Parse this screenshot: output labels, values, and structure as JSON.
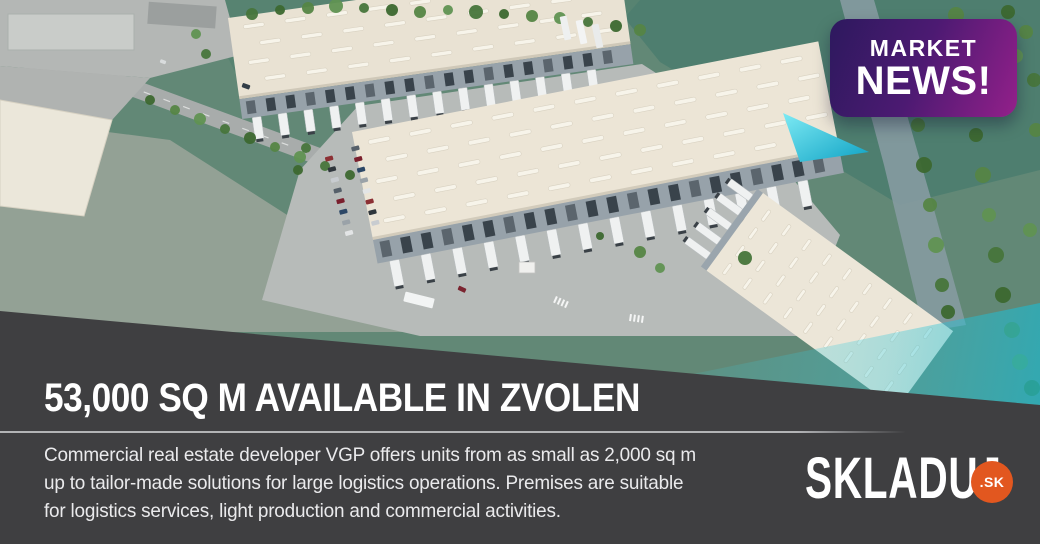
{
  "badge": {
    "line1": "MARKET",
    "line2": "NEWS!",
    "gradient_from": "#2d195e",
    "gradient_to": "#93208a",
    "tail_color": "#2ec3d8"
  },
  "panel": {
    "headline": "53,000 SQ M AVAILABLE IN ZVOLEN",
    "body_lines": [
      "Commercial real estate developer VGP offers units from as small as 2,000 sq m",
      "up to tailor-made solutions for large logistics operations. Premises are suitable",
      "for logistics services, light production and commercial activities."
    ],
    "background_color": "#3f3f41",
    "text_color": "#ffffff"
  },
  "logo": {
    "wordmark": "SKLADUJ",
    "tld": ".SK",
    "tld_badge_color": "#e2571f"
  },
  "scene": {
    "overlay_accent_color": "#2ec3d8",
    "grass_color": "#628876",
    "roof_color": "#e9e2d3"
  }
}
